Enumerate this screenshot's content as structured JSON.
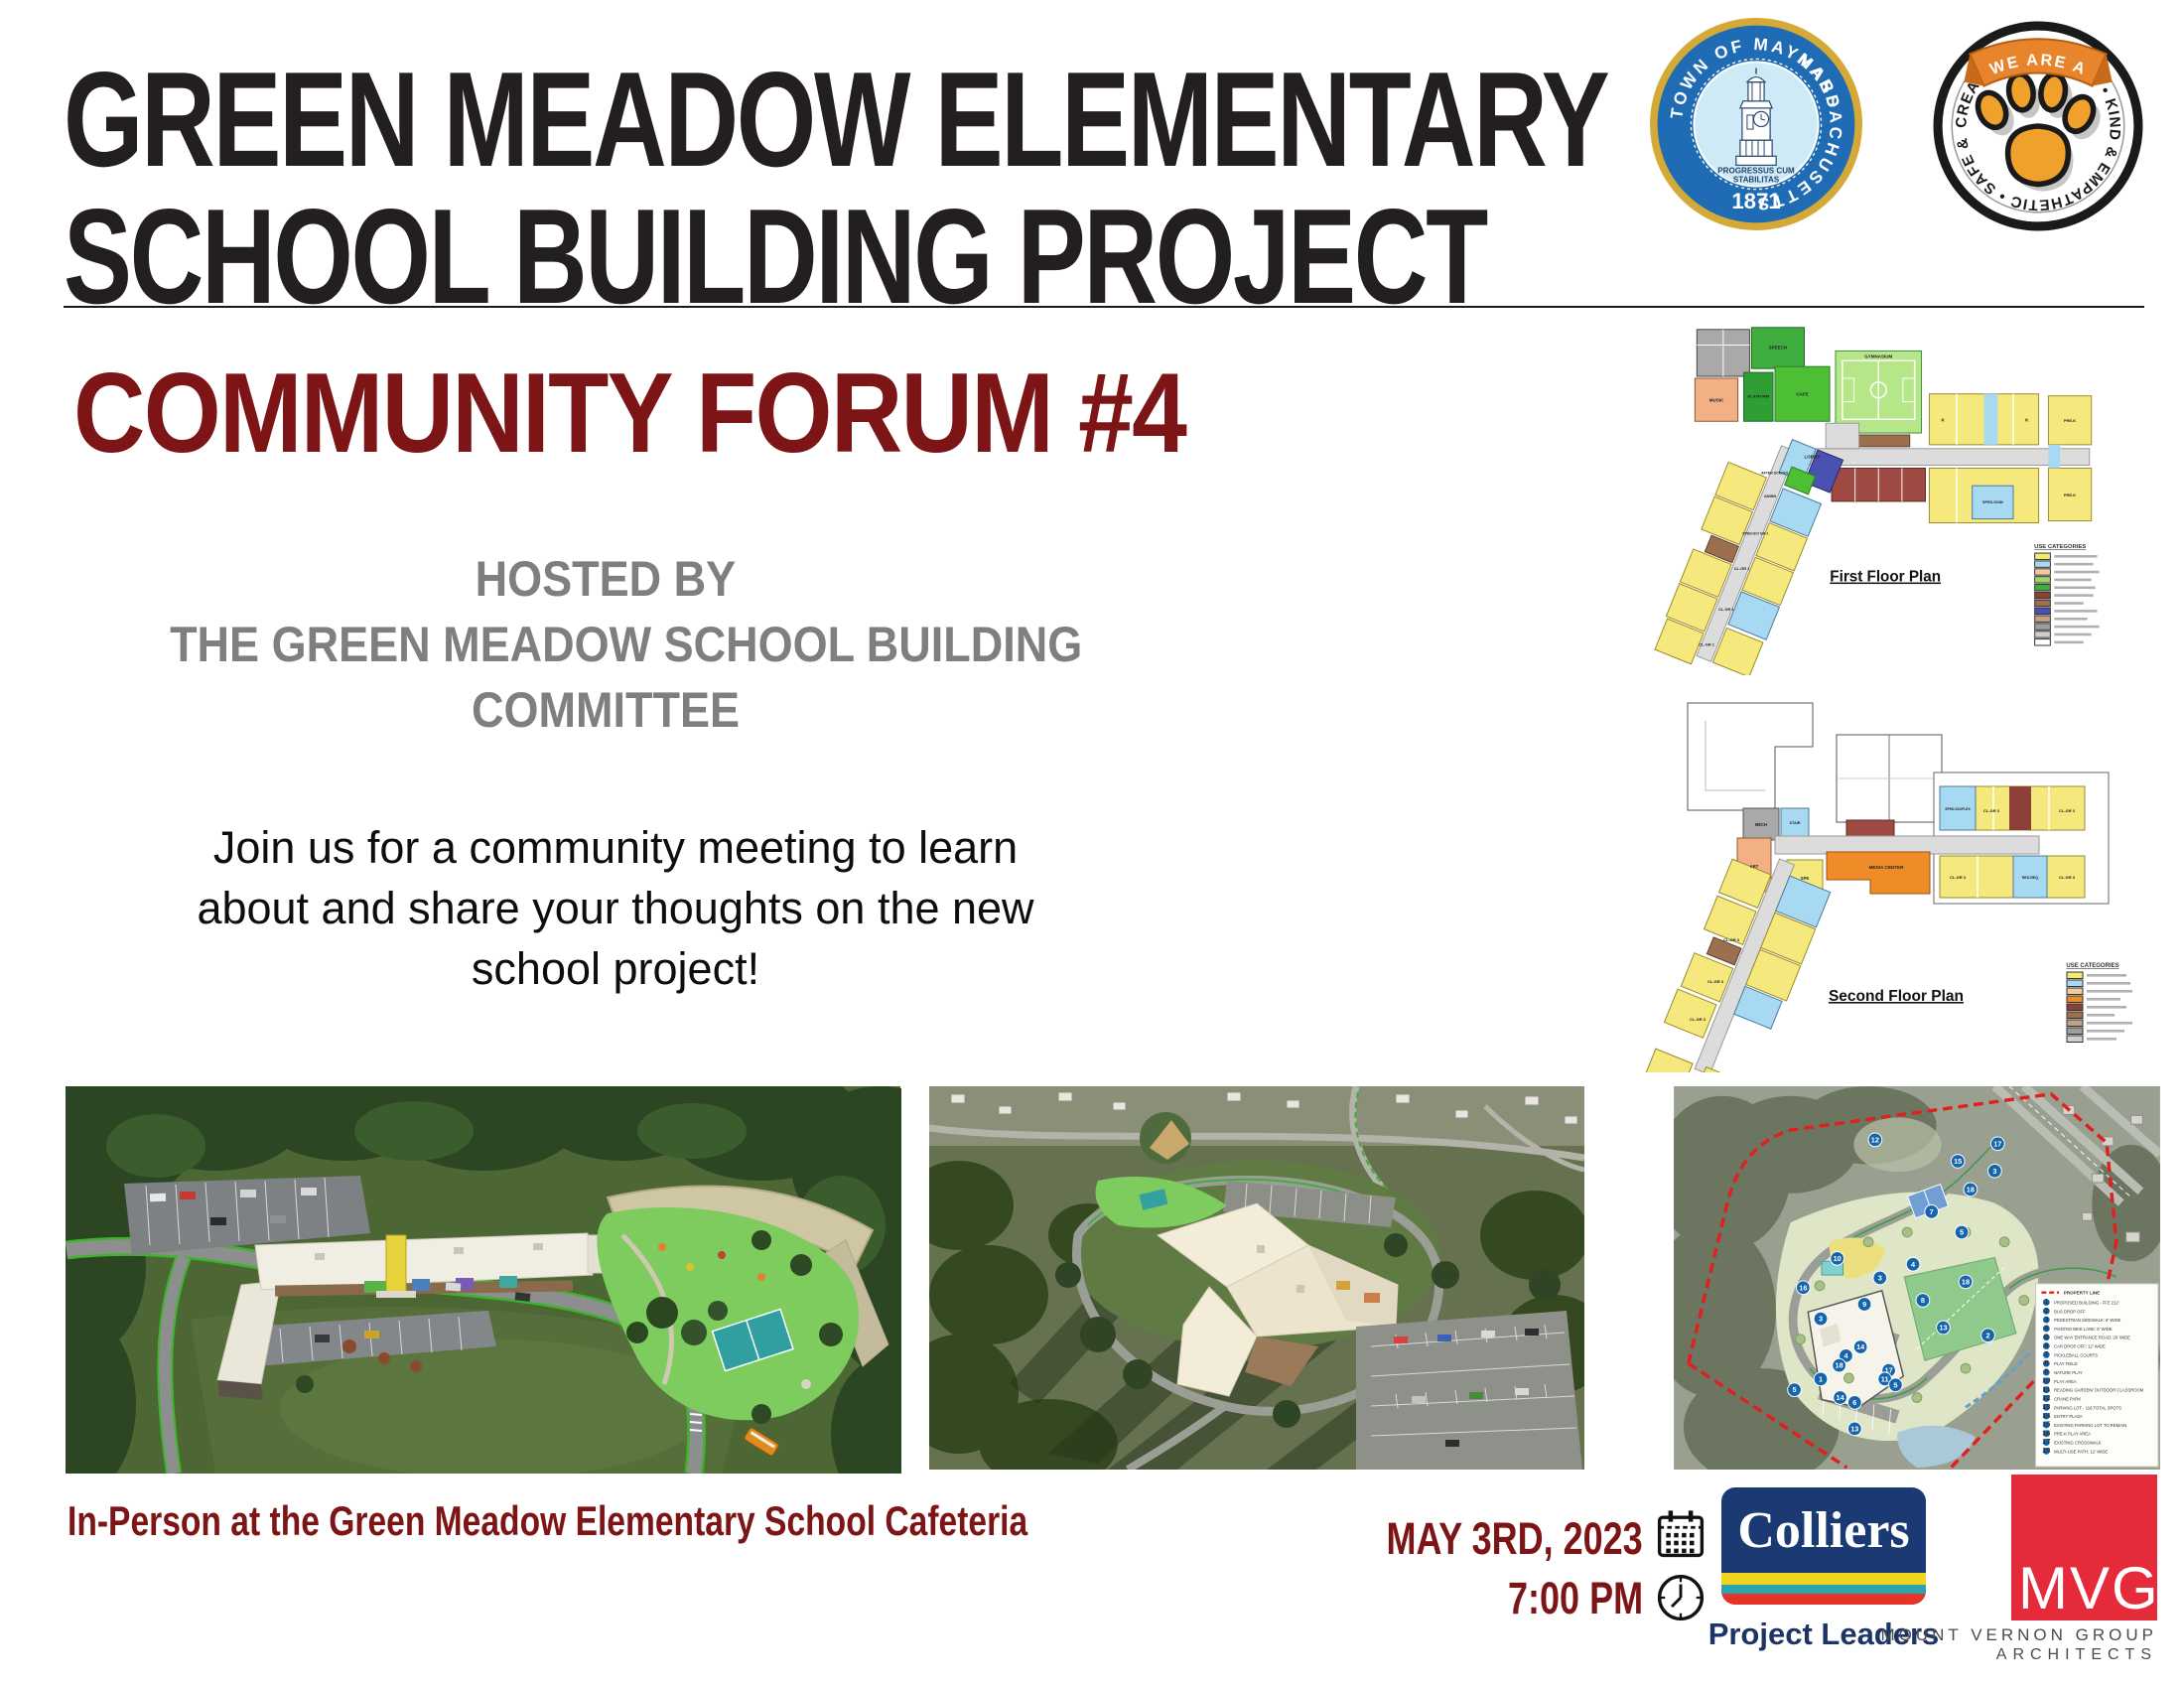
{
  "header": {
    "title_line1": "GREEN MEADOW ELEMENTARY",
    "title_line2": "SCHOOL BUILDING PROJECT",
    "seal": {
      "ring_text_left": "TOWN OF MAYNARD",
      "ring_text_right": "MASSACHUSETTS",
      "motto_line1": "PROGRESSUS CUM",
      "motto_line2": "STABILITAS",
      "year": "1871"
    },
    "paw": {
      "banner_text": "• WE ARE A •",
      "ring_text": "CREATIVE & CURIOUS  •  KIND & EMPATHETIC  •  SAFE & HEALTHY  •"
    }
  },
  "forum": {
    "heading": "COMMUNITY FORUM #4",
    "hosted_line1": "HOSTED BY",
    "hosted_line2": "THE GREEN MEADOW SCHOOL BUILDING",
    "hosted_line3": "COMMITTEE",
    "body_line1": "Join us for a community meeting to learn",
    "body_line2": "about and share your thoughts on the new",
    "body_line3": "school project!"
  },
  "plans": {
    "first": {
      "label": "First Floor Plan",
      "legend_title": "USE CATEGORIES",
      "rooms": {
        "speech": "SPEECH",
        "music": "MUSIC",
        "platform": "PLATFORM",
        "cafe": "CAFE",
        "gym": "GYMNASIUM",
        "lobby": "LOBBY",
        "after_school": "AFTER SCHOOL",
        "admin": "ADMIN",
        "sped": "SPED-SCI GR-1",
        "cl": "CL-GR 1",
        "prek": "PRE-K",
        "spedscim": "SPED-SCIM",
        "k": "K"
      }
    },
    "second": {
      "label": "Second Floor Plan",
      "legend_title": "USE CATEGORIES",
      "rooms": {
        "mech": "MECH",
        "stair": "STAIR",
        "art": "ART",
        "spe": "SPE",
        "media": "MEDIA CENTER",
        "sped": "SPED-SCI/FLEX",
        "cl": "CL-GR 3",
        "res": "RES-REQ"
      }
    },
    "use_colors_first": [
      "#f5e96e",
      "#a7d9f2",
      "#f4c79c",
      "#9fd468",
      "#3fae3f",
      "#8e3f38",
      "#9c6f4e",
      "#4a51b0",
      "#c2a283",
      "#9e9e9e",
      "#cfcfcf",
      "#ffffff"
    ],
    "use_colors_second": [
      "#f5e96e",
      "#a7d9f2",
      "#f4c79c",
      "#f08c28",
      "#8e3f38",
      "#9c6f4e",
      "#c2a283",
      "#9e9e9e",
      "#cfcfcf"
    ]
  },
  "site_plan": {
    "property_line_label": "PROPERTY LINE",
    "legend": [
      {
        "num": "1",
        "label": "PROPOSED BUILDING - FFE 212'"
      },
      {
        "num": "2",
        "label": "BUS DROP OFF"
      },
      {
        "num": "3",
        "label": "PEDESTRIAN SIDEWALK: 6' WIDE"
      },
      {
        "num": "4",
        "label": "PAINTED BIKE LANE: 6' WIDE"
      },
      {
        "num": "5",
        "label": "ONE WAY ENTRANCE ROAD; 20' WIDE"
      },
      {
        "num": "6",
        "label": "CAR DROP OFF: 12' WIDE"
      },
      {
        "num": "7",
        "label": "PICKLEBALL COURTS"
      },
      {
        "num": "8",
        "label": "PLAY FIELD"
      },
      {
        "num": "9",
        "label": "NATURE PLAY"
      },
      {
        "num": "10",
        "label": "PLAY AREA"
      },
      {
        "num": "11",
        "label": "READING GARDEN/ OUTDOOR CLASSROOM"
      },
      {
        "num": "12",
        "label": "CRANE PARK"
      },
      {
        "num": "13",
        "label": "PARKING LOT - 116 TOTAL SPOTS"
      },
      {
        "num": "14",
        "label": "ENTRY PLAZA"
      },
      {
        "num": "15",
        "label": "EXISTING PARKING LOT TO REMAIN"
      },
      {
        "num": "16",
        "label": "PRE-K PLAY AREA"
      },
      {
        "num": "17",
        "label": "EXISTING CROSSWALK"
      },
      {
        "num": "18",
        "label": "MULTI-USE PATH: 12' WIDE"
      }
    ],
    "markers": [
      "12",
      "17",
      "15",
      "3",
      "18",
      "7",
      "5",
      "10",
      "4",
      "3",
      "18",
      "16",
      "9",
      "8",
      "3",
      "13",
      "2",
      "14",
      "4",
      "18",
      "17",
      "1",
      "11",
      "5",
      "5",
      "14",
      "6",
      "13"
    ]
  },
  "footer": {
    "location": "In-Person at the Green Meadow Elementary School Cafeteria",
    "date": "MAY 3RD, 2023",
    "time": "7:00 PM",
    "colliers": {
      "name": "Colliers",
      "tagline": "Project Leaders"
    },
    "mvg": {
      "initials": "MVG",
      "line1": "MOUNT VERNON GROUP",
      "line2": "ARCHITECTS"
    }
  },
  "colors": {
    "maroon": "#7d1517",
    "title": "#231f20",
    "gray_text": "#7f7f7f",
    "colliers_navy": "#1b3a73",
    "colliers_yellow": "#efd41f",
    "colliers_teal": "#2ca4ae",
    "colliers_red": "#e5332a",
    "mvg_red": "#e52a3a",
    "seal_blue": "#1f6cb5",
    "seal_gold": "#d4a937",
    "paw_orange": "#f0a12c",
    "banner_orange": "#e8842c",
    "property_line_red": "#e01f1f",
    "marker_blue": "#1565ad"
  }
}
